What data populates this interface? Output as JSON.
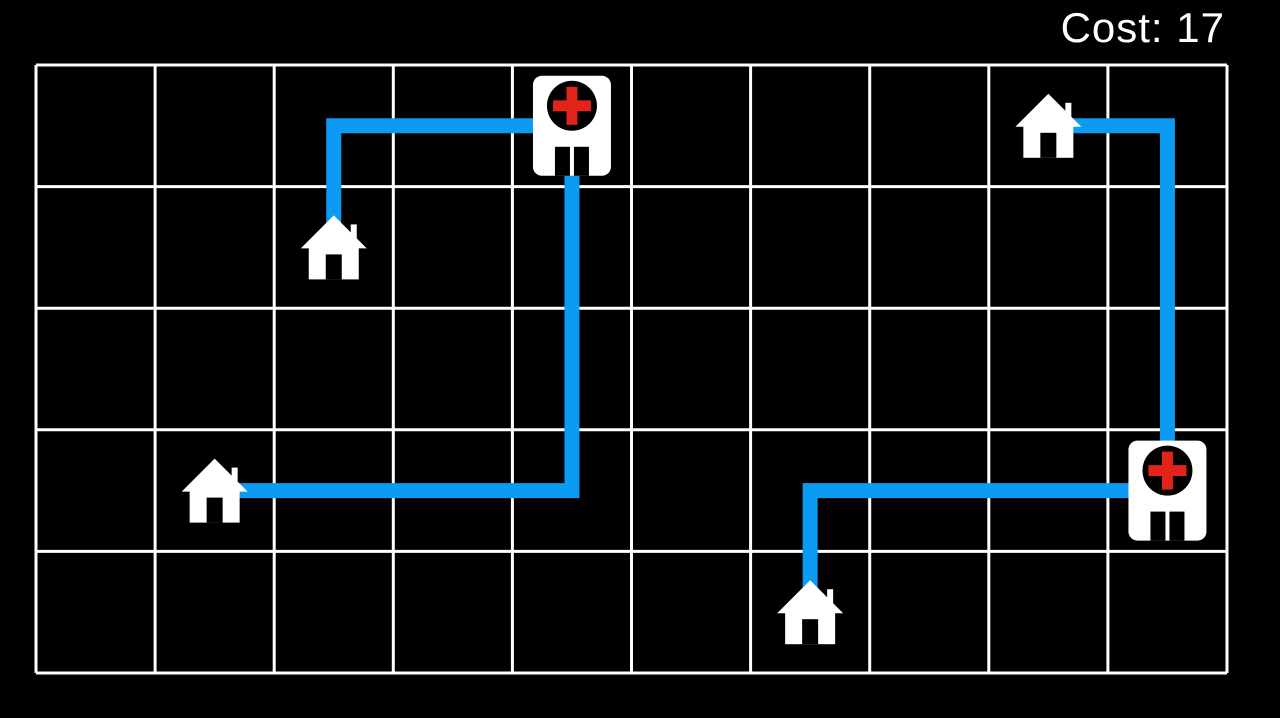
{
  "hud": {
    "cost_label": "Cost: 17",
    "cost_value": 17
  },
  "colors": {
    "background": "#000000",
    "grid_line": "#ffffff",
    "path": "#0b9bf2",
    "icon": "#ffffff",
    "icon_cutout": "#000000",
    "hospital_cross": "#e2231a"
  },
  "board": {
    "x": 36,
    "y": 65,
    "width": 1191,
    "height": 608,
    "cols": 10,
    "rows": 5,
    "line_width": 3,
    "path_width": 15,
    "house_trim_h": 23,
    "house_trim_v": 20
  },
  "entities": [
    {
      "type": "hospital",
      "name": "hospital-top",
      "col": 4,
      "row": 0
    },
    {
      "type": "hospital",
      "name": "hospital-right",
      "col": 9,
      "row": 3
    },
    {
      "type": "house",
      "name": "house-upper-left",
      "col": 2,
      "row": 1
    },
    {
      "type": "house",
      "name": "house-mid-left",
      "col": 1,
      "row": 3
    },
    {
      "type": "house",
      "name": "house-bottom",
      "col": 6,
      "row": 4
    },
    {
      "type": "house",
      "name": "house-top-right",
      "col": 8,
      "row": 0
    }
  ],
  "paths": [
    {
      "name": "route-house-upper-left-to-hospital-top",
      "cost": 3,
      "cells": [
        [
          2,
          1
        ],
        [
          2,
          0
        ],
        [
          4,
          0
        ]
      ]
    },
    {
      "name": "route-hospital-top-to-house-mid-left",
      "cost": 6,
      "cells": [
        [
          4,
          0
        ],
        [
          4,
          3
        ],
        [
          1,
          3
        ]
      ]
    },
    {
      "name": "route-house-bottom-to-hospital-right",
      "cost": 4,
      "cells": [
        [
          6,
          4
        ],
        [
          6,
          3
        ],
        [
          9,
          3
        ]
      ]
    },
    {
      "name": "route-house-top-right-to-hospital-right",
      "cost": 4,
      "cells": [
        [
          8,
          0
        ],
        [
          9,
          0
        ],
        [
          9,
          3
        ]
      ]
    }
  ]
}
